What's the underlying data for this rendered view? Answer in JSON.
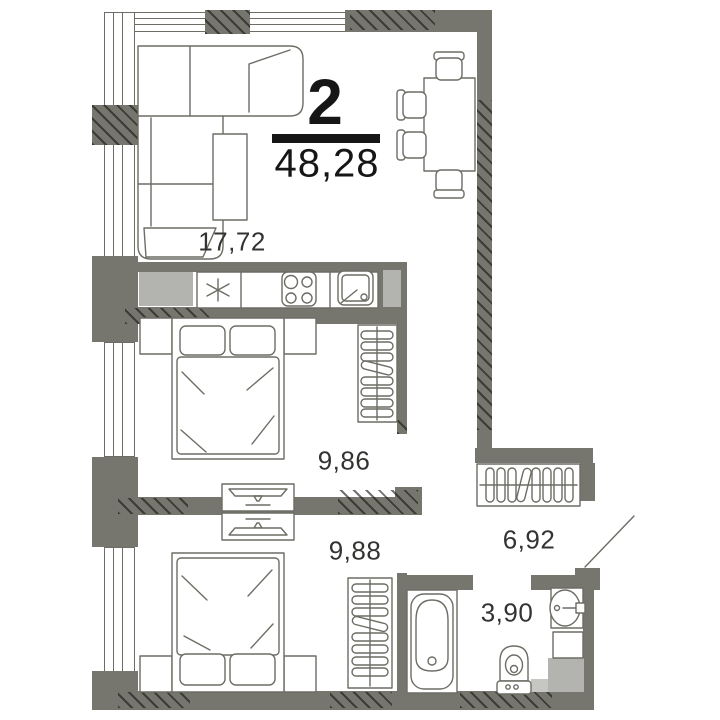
{
  "plan": {
    "rooms_count": "2",
    "total_area": "48,28",
    "rooms": [
      {
        "id": "living-kitchen",
        "area": "17,72"
      },
      {
        "id": "bedroom-1",
        "area": "9,86"
      },
      {
        "id": "bedroom-2",
        "area": "9,88"
      },
      {
        "id": "hallway",
        "area": "6,92"
      },
      {
        "id": "bathroom",
        "area": "3,90"
      }
    ],
    "colors": {
      "wall": "#76766e",
      "shaft": "#b3b3af",
      "outline": "#6d6d65",
      "label_text": "#333331",
      "accent": "#161616",
      "background": "#ffffff"
    },
    "furniture_icons": [
      "sofa-icon",
      "coffee-table-icon",
      "dining-table-icon",
      "chair-icon",
      "fridge-asterisk-icon",
      "stove-icon",
      "kitchen-sink-icon",
      "wardrobe-icon",
      "closet-icon",
      "double-bed-icon",
      "tv-icon",
      "bathtub-icon",
      "toilet-icon",
      "washbasin-icon",
      "cabinet-icon",
      "entrance-door-icon"
    ]
  }
}
